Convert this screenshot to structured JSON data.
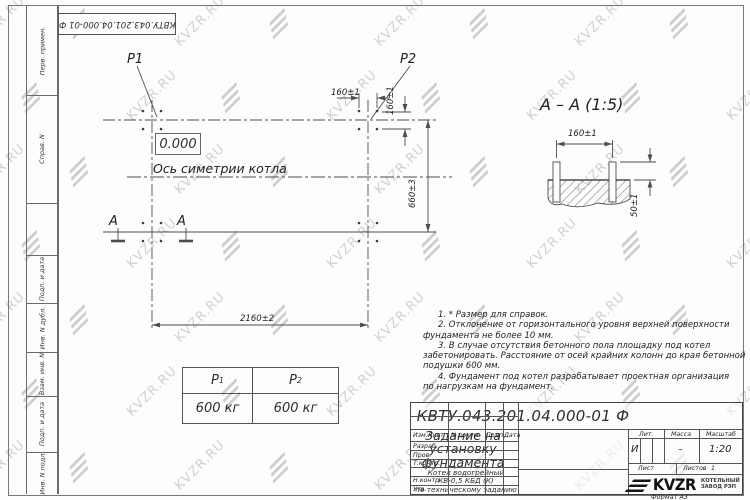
{
  "watermark": {
    "text": "KVZR.RU"
  },
  "corner_stamp": {
    "text": "КВТУ.043.201.04.000-01 Ф"
  },
  "margin_labels": [
    "Перв. примен.",
    "Справ. N",
    "Подп. и дата",
    "Инв. N дубл.",
    "Взам. инв. N",
    "Подп. и дата",
    "Инв. N подл."
  ],
  "plan": {
    "p1": "P1",
    "p2": "P2",
    "level": "0.000",
    "axis_caption": "Ось симетрии котла",
    "dim_top": "160±1",
    "dim_right_small": "160±1",
    "dim_width": "2160±2",
    "dim_height": "660±3",
    "section_mark_left": "А",
    "section_mark_right": "А"
  },
  "section_view": {
    "title": "А – А (1:5)",
    "dim_width": "160±1",
    "dim_height": "50±1"
  },
  "notes": [
    [
      "1. * Размер для справок."
    ],
    [
      "2. Отклонение от горизонтального уровня верхней поверхности",
      "фундамента не более 10 мм."
    ],
    [
      "3. В случае отсутствия бетонного пола площадку под котел",
      "забетонировать. Расстояние от осей крайних колонн до края бетонной",
      "подушки 600 мм."
    ],
    [
      "4. Фундамент под котел разрабатывает проектная организация",
      "по нагрузкам на фундамент."
    ]
  ],
  "load_table": {
    "col1": {
      "base": "P",
      "sub": "1",
      "value": "600 кг"
    },
    "col2": {
      "base": "P",
      "sub": "2",
      "value": "600 кг"
    }
  },
  "title_block": {
    "doc_number": "КВТУ.043.201.04.000-01 Ф",
    "title": "Задание на установку фундамента",
    "subtitle1": "Котел водогрейный",
    "subtitle2": "КВ-0,5 КБД (К)",
    "subtitle3": "по техническому заданию",
    "col_headers": [
      "Изм.Лист",
      "N докум.",
      "Подп.",
      "Дата"
    ],
    "row_labels": [
      "Разраб.",
      "Пров.",
      "Т.контр.",
      "Н.контр.",
      "Утв."
    ],
    "lit_label": "Лит.",
    "lit_value": "И",
    "mass_label": "Масса",
    "mass_value": "–",
    "scale_label": "Масштаб",
    "scale_value": "1:20",
    "sheet_label": "Лист",
    "sheets_label": "Листов",
    "sheets_value": "1",
    "logo_text": "KVZR",
    "logo_caption1": "КОТЕЛЬНЫЙ",
    "logo_caption2": "ЗАВОД РЭП",
    "format": "Формат А3"
  }
}
